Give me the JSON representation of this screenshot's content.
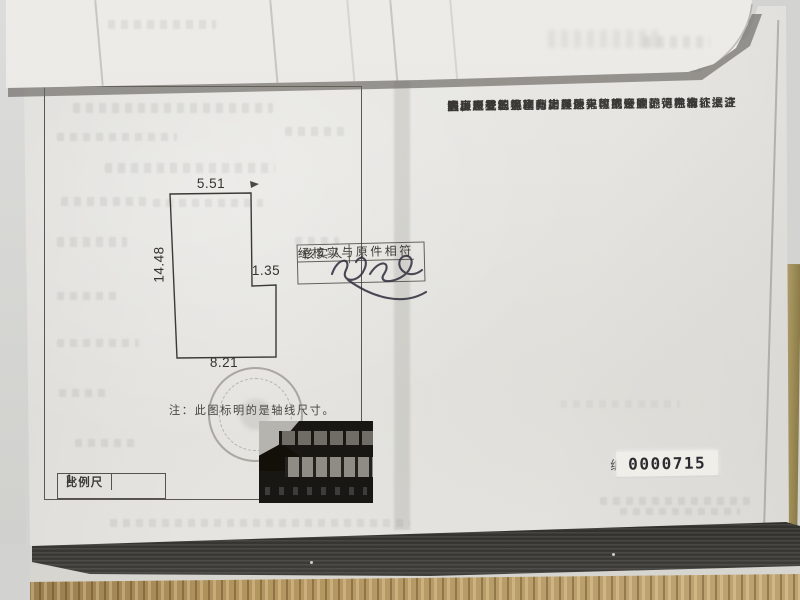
{
  "page": {
    "clauses": [
      {
        "marker": "一、",
        "lines": [
          "本证是权利人享有房屋所有权的证明。"
        ]
      },
      {
        "marker": "二、",
        "lines": [
          "房屋所有权人、利害关系人可到房屋登记机构依法查",
          "询房屋登记簿。"
        ]
      },
      {
        "marker": "三、",
        "lines": [
          "本证记载的事项与房屋登记簿不一致的，除有证据证",
          "明房屋登记簿确有错误外，以房屋登记簿为准。"
        ]
      },
      {
        "marker": "四、",
        "lines": [
          "除房屋登记机构外，其他单位或个人不得在本证上注",
          "记事项或加盖印章。"
        ]
      },
      {
        "marker": "五、",
        "lines": [
          "本证应妥善保管，如有遗失、损毁的，可申请补发。"
        ]
      }
    ],
    "serial": {
      "label": "编号：",
      "number": "0000715"
    }
  },
  "plan": {
    "dimensions": {
      "top": "5.51",
      "left": "14.48",
      "step": "1.35",
      "bottom": "8.21"
    },
    "note": "注：此图标明的是轴线尺寸。",
    "scale_bar": {
      "label": "比例尺",
      "value": "1:"
    }
  },
  "verification_stamp": {
    "line1": "经核实与原件相符",
    "role": "核实人"
  },
  "colors": {
    "paper": "#e4e3df",
    "ink": "#3a3936",
    "stamp_ink": "#6b6660",
    "desk_wood": "#b2955f",
    "pages_edge": "#1c1b18"
  }
}
